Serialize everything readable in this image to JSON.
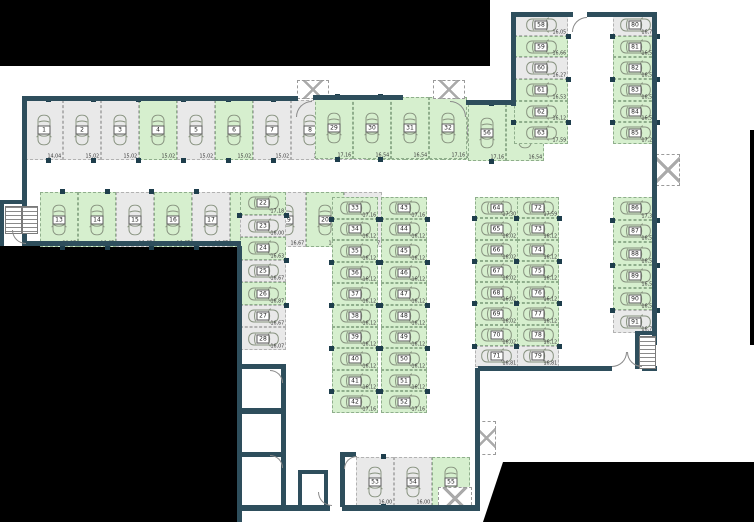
{
  "colors": {
    "available_space": "#d6efce",
    "occupied_space": "#e9e9e9",
    "wall": "#2e4e5c",
    "background_mask": "#000000"
  },
  "icons": {
    "car": "car-icon",
    "stairs": "stairs-icon",
    "shaft": "x-hatch-icon",
    "door": "door-arc-icon"
  },
  "groups": [
    {
      "id": "row_1_12",
      "spaces": [
        {
          "n": "1",
          "area": "14,04",
          "state": "gray"
        },
        {
          "n": "2",
          "area": "15,02",
          "state": "gray"
        },
        {
          "n": "3",
          "area": "15,02",
          "state": "gray"
        },
        {
          "n": "4",
          "area": "15,02",
          "state": "green"
        },
        {
          "n": "5",
          "area": "15,02",
          "state": "gray"
        },
        {
          "n": "6",
          "area": "15,02",
          "state": "green"
        },
        {
          "n": "7",
          "area": "15,02",
          "state": "gray"
        },
        {
          "n": "8",
          "area": "15,02",
          "state": "gray"
        },
        {
          "n": "9",
          "area": "15,02",
          "state": "gray"
        },
        {
          "n": "10",
          "area": "16,06",
          "state": "green"
        },
        {
          "n": "11",
          "area": "16,35",
          "state": "green"
        },
        {
          "n": "12",
          "area": "17,37",
          "state": "green"
        }
      ]
    },
    {
      "id": "row_13_21",
      "spaces": [
        {
          "n": "13",
          "area": "20,27",
          "state": "green"
        },
        {
          "n": "14",
          "area": "16,67",
          "state": "green"
        },
        {
          "n": "15",
          "area": "16,67",
          "state": "gray"
        },
        {
          "n": "16",
          "area": "16,67",
          "state": "green"
        },
        {
          "n": "17",
          "area": "16,67",
          "state": "gray"
        },
        {
          "n": "18",
          "area": "16,67",
          "state": "green"
        },
        {
          "n": "19",
          "area": "16,67",
          "state": "gray"
        },
        {
          "n": "20",
          "area": "16,67",
          "state": "green"
        },
        {
          "n": "21",
          "area": "16,67",
          "state": "gray"
        }
      ]
    },
    {
      "id": "col_22_28",
      "spaces": [
        {
          "n": "22",
          "area": "17,18",
          "state": "green"
        },
        {
          "n": "23",
          "area": "16,00",
          "state": "gray"
        },
        {
          "n": "24",
          "area": "16,63",
          "state": "green"
        },
        {
          "n": "25",
          "area": "16,67",
          "state": "gray"
        },
        {
          "n": "26",
          "area": "16,87",
          "state": "green"
        },
        {
          "n": "27",
          "area": "16,67",
          "state": "gray"
        },
        {
          "n": "28",
          "area": "16,07",
          "state": "gray"
        }
      ]
    },
    {
      "id": "row_29_32",
      "spaces": [
        {
          "n": "29",
          "area": "17,16",
          "state": "green"
        },
        {
          "n": "30",
          "area": "16,54",
          "state": "green"
        },
        {
          "n": "31",
          "area": "16,54",
          "state": "green"
        },
        {
          "n": "32",
          "area": "17,16",
          "state": "green"
        }
      ]
    },
    {
      "id": "col_33_42",
      "spaces": [
        {
          "n": "33",
          "area": "17,16",
          "state": "green"
        },
        {
          "n": "34",
          "area": "16,12",
          "state": "green"
        },
        {
          "n": "35",
          "area": "16,12",
          "state": "green"
        },
        {
          "n": "36",
          "area": "16,12",
          "state": "green"
        },
        {
          "n": "37",
          "area": "16,12",
          "state": "green"
        },
        {
          "n": "38",
          "area": "16,12",
          "state": "green"
        },
        {
          "n": "39",
          "area": "16,12",
          "state": "green"
        },
        {
          "n": "40",
          "area": "16,12",
          "state": "green"
        },
        {
          "n": "41",
          "area": "16,12",
          "state": "green"
        },
        {
          "n": "42",
          "area": "17,16",
          "state": "green"
        }
      ]
    },
    {
      "id": "col_43_52",
      "spaces": [
        {
          "n": "43",
          "area": "17,16",
          "state": "green"
        },
        {
          "n": "44",
          "area": "16,12",
          "state": "green"
        },
        {
          "n": "45",
          "area": "16,12",
          "state": "green"
        },
        {
          "n": "46",
          "area": "16,12",
          "state": "green"
        },
        {
          "n": "47",
          "area": "16,12",
          "state": "green"
        },
        {
          "n": "48",
          "area": "16,12",
          "state": "green"
        },
        {
          "n": "49",
          "area": "16,12",
          "state": "green"
        },
        {
          "n": "50",
          "area": "16,12",
          "state": "green"
        },
        {
          "n": "51",
          "area": "16,12",
          "state": "green"
        },
        {
          "n": "52",
          "area": "17,16",
          "state": "green"
        }
      ]
    },
    {
      "id": "row_53_55",
      "spaces": [
        {
          "n": "53",
          "area": "16,00",
          "state": "gray"
        },
        {
          "n": "54",
          "area": "16,00",
          "state": "gray"
        },
        {
          "n": "55",
          "area": "17,00",
          "state": "green"
        }
      ]
    },
    {
      "id": "row_56_57",
      "spaces": [
        {
          "n": "56",
          "area": "17,16",
          "state": "green"
        },
        {
          "n": "57",
          "area": "16,54",
          "state": "green"
        }
      ]
    },
    {
      "id": "col_58_63",
      "spaces": [
        {
          "n": "58",
          "area": "16,05",
          "state": "gray"
        },
        {
          "n": "59",
          "area": "16,66",
          "state": "green"
        },
        {
          "n": "60",
          "area": "16,27",
          "state": "gray"
        },
        {
          "n": "61",
          "area": "16,53",
          "state": "green"
        },
        {
          "n": "62",
          "area": "16,12",
          "state": "green"
        },
        {
          "n": "63",
          "area": "17,59",
          "state": "green"
        }
      ]
    },
    {
      "id": "col_64_71",
      "spaces": [
        {
          "n": "64",
          "area": "17,30",
          "state": "green"
        },
        {
          "n": "65",
          "area": "16,02",
          "state": "green"
        },
        {
          "n": "66",
          "area": "16,02",
          "state": "green"
        },
        {
          "n": "67",
          "area": "16,02",
          "state": "green"
        },
        {
          "n": "68",
          "area": "16,02",
          "state": "green"
        },
        {
          "n": "69",
          "area": "16,02",
          "state": "green"
        },
        {
          "n": "70",
          "area": "16,02",
          "state": "green"
        },
        {
          "n": "71",
          "area": "16,81",
          "state": "gray"
        }
      ]
    },
    {
      "id": "col_72_79",
      "spaces": [
        {
          "n": "72",
          "area": "17,59",
          "state": "green"
        },
        {
          "n": "73",
          "area": "16,12",
          "state": "green"
        },
        {
          "n": "74",
          "area": "16,12",
          "state": "green"
        },
        {
          "n": "75",
          "area": "16,12",
          "state": "green"
        },
        {
          "n": "76",
          "area": "16,12",
          "state": "green"
        },
        {
          "n": "77",
          "area": "16,12",
          "state": "green"
        },
        {
          "n": "78",
          "area": "16,12",
          "state": "green"
        },
        {
          "n": "79",
          "area": "16,81",
          "state": "gray"
        }
      ]
    },
    {
      "id": "col_80_85",
      "spaces": [
        {
          "n": "80",
          "area": "16,76",
          "state": "gray"
        },
        {
          "n": "81",
          "area": "16,53",
          "state": "green"
        },
        {
          "n": "82",
          "area": "16,53",
          "state": "green"
        },
        {
          "n": "83",
          "area": "16,53",
          "state": "green"
        },
        {
          "n": "84",
          "area": "16,53",
          "state": "green"
        },
        {
          "n": "85",
          "area": "17,27",
          "state": "green"
        }
      ]
    },
    {
      "id": "col_86_91",
      "spaces": [
        {
          "n": "86",
          "area": "17,37",
          "state": "green"
        },
        {
          "n": "87",
          "area": "16,53",
          "state": "green"
        },
        {
          "n": "88",
          "area": "16,53",
          "state": "green"
        },
        {
          "n": "89",
          "area": "16,53",
          "state": "green"
        },
        {
          "n": "90",
          "area": "16,53",
          "state": "green"
        },
        {
          "n": "91",
          "area": "16,76",
          "state": "gray"
        }
      ]
    }
  ]
}
